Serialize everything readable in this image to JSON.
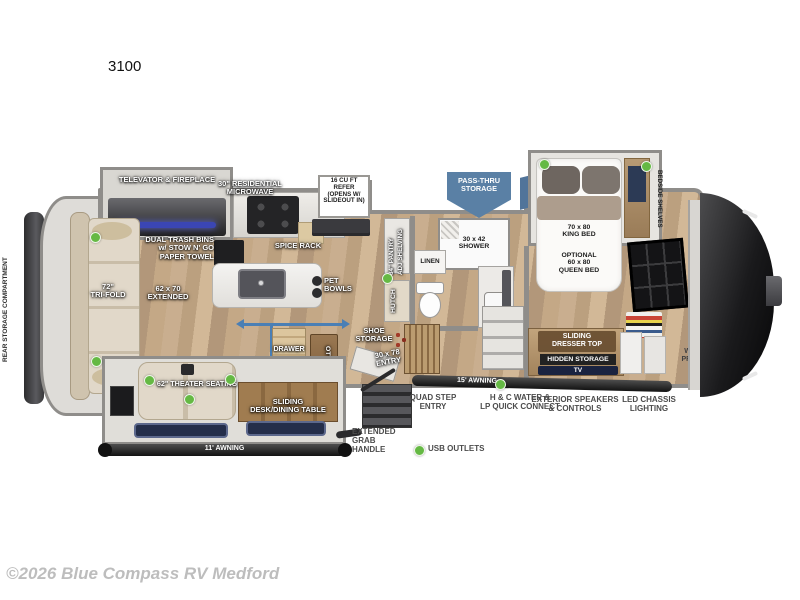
{
  "title": "3100",
  "footer": "©2026 Blue Compass RV Medford",
  "colors": {
    "usb_dot": "#65b944",
    "pass_thru_arrow": "#5a80a5",
    "slide_motion_arrow": "#4a7fb5",
    "awning_bar": "#1e1e1e",
    "wall": "#8f8d8a",
    "wood_floor": "#c0a483"
  },
  "legend": {
    "usb": "USB OUTLETS"
  },
  "labels": {
    "rear_storage": "REAR STORAGE COMPARTMENT",
    "televator": "TELEVATOR & FIREPLACE",
    "microwave": "30\" RESIDENTIAL\nMICROWAVE",
    "refer": "16 CU FT\nREFER\n(OPENS W/\nSLIDEOUT IN)",
    "trash_bins": "DUAL TRASH BINS\nw/ STOW N' GO\nPAPER TOWEL",
    "spice_rack": "SPICE RACK",
    "tri_fold": "72\"\nTRI-FOLD",
    "extended": "62 x 70\nEXTENDED",
    "pet_bowls": "PET\nBOWLS",
    "pantry_line1": "84\" PANTRY",
    "pantry_line2": "ADJ SHELVING",
    "hutch": "HUTCH",
    "pass_thru": "PASS-THRU\nSTORAGE",
    "linen": "LINEN",
    "shower": "30 x 42\nSHOWER",
    "king_bed": "70 x 80\nKING BED",
    "queen_bed": "OPTIONAL\n60 x 80\nQUEEN BED",
    "bedside_shelves": "BEDSIDE SHELVES",
    "wardrobe_line1": "WARDROBE SHELF",
    "wardrobe_line2": "& SHOE RACK",
    "theater": "62\" THEATER SEATING",
    "drawer": "DRAWER",
    "ottoman": "OTTOMAN",
    "desk_table": "SLIDING\nDESK/DINING TABLE",
    "shoe_storage": "SHOE\nSTORAGE",
    "entry": "30 x 78\nENTRY",
    "dresser": "SLIDING\nDRESSER TOP",
    "hidden_storage": "HIDDEN STORAGE",
    "tv": "TV",
    "wd_prep": "W/D\nPREP",
    "awning_11": "11' AWNING",
    "awning_15": "15' AWNING",
    "quad_step": "QUAD STEP\nENTRY",
    "water_connect": "H & C WATER &\nLP QUICK CONNECT",
    "speakers": "EXTERIOR SPEAKERS\n& CONTROLS",
    "chassis_lighting": "LED CHASSIS\nLIGHTING",
    "grab_handle": "EXTENDED\nGRAB\nHANDLE"
  }
}
